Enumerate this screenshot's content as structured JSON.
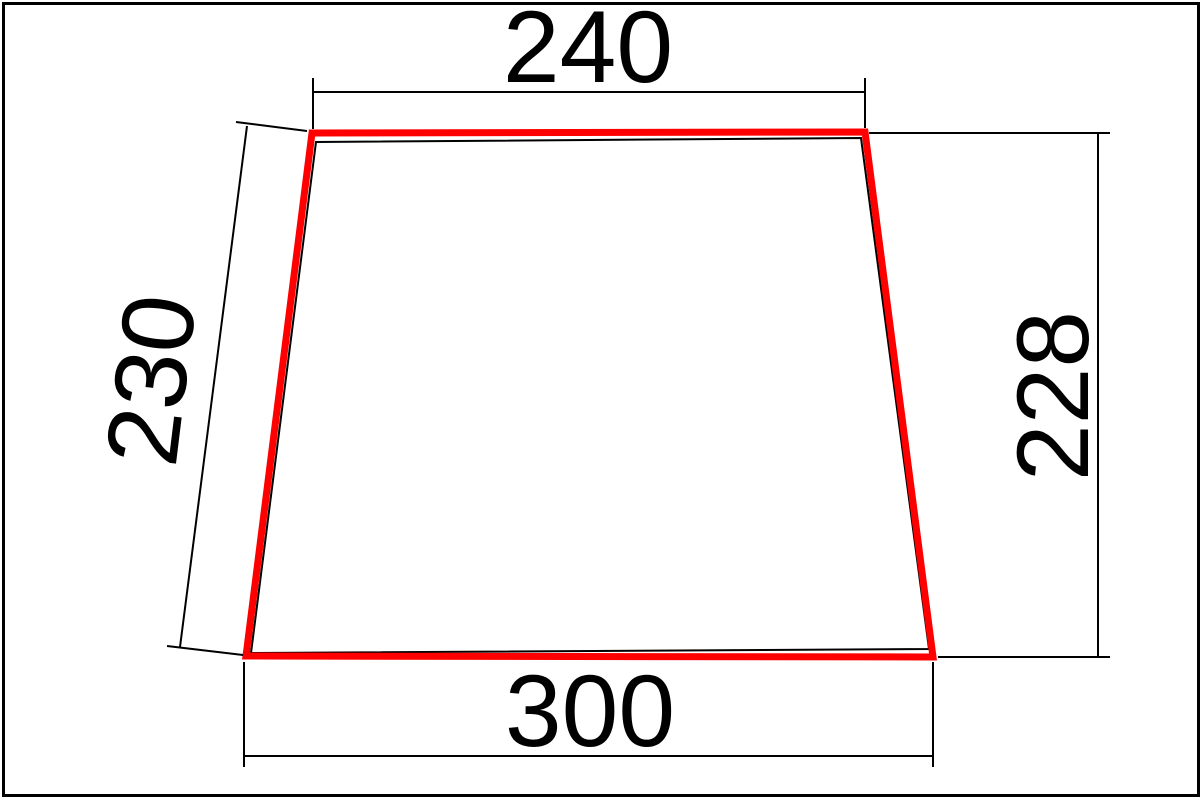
{
  "drawing": {
    "background_color": "#ffffff",
    "border_color": "#000000",
    "panel_outline_color": "#fe0000",
    "underlay_outline_color": "#000000",
    "dimension_line_color": "#000000",
    "dimension_labels": {
      "top_width": "240",
      "bottom_width": "300",
      "left_side": "230",
      "right_side": "228"
    }
  }
}
